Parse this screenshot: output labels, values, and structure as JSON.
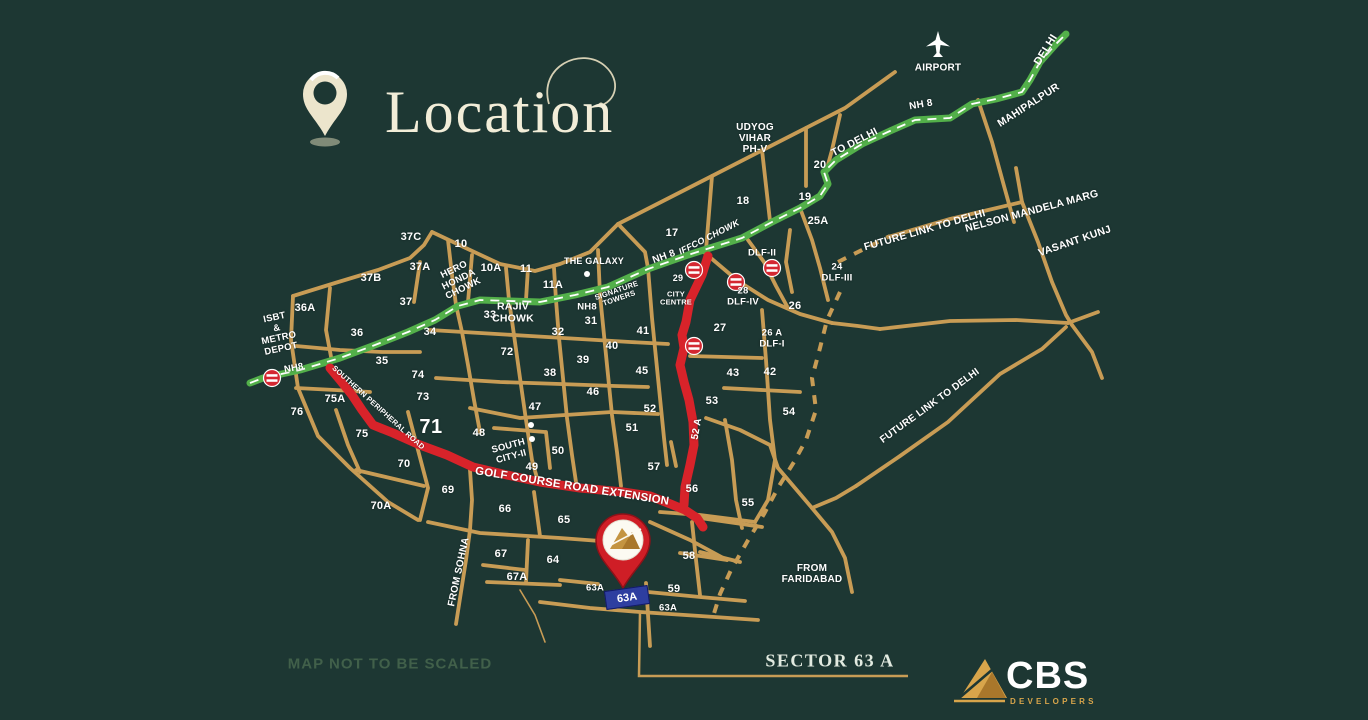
{
  "header": {
    "title": "Location"
  },
  "footer": {
    "disclaimer": "MAP NOT TO BE SCALED",
    "sector_label": "SECTOR 63 A",
    "logo_name": "CBS",
    "logo_sub": "DEVELOPERS"
  },
  "colors": {
    "background": "#1d3733",
    "road": "#c89c55",
    "highway_green": "#53b04a",
    "route_red": "#d8232a",
    "title_cream": "#f2edd8",
    "highlight_blue": "#2e3ea0",
    "logo_gold": "#d8a54b"
  },
  "icons": [
    "location-pin-icon",
    "airplane-icon",
    "metro-station-icon",
    "site-pin-icon",
    "cbs-mountain-icon"
  ],
  "map": {
    "highlight": "63A",
    "labels": [
      {
        "t": "AIRPORT",
        "x": 938,
        "y": 68,
        "s": 10,
        "cls": "wb"
      },
      {
        "t": "DELHI",
        "x": 1046,
        "y": 50,
        "r": -58,
        "s": 11,
        "cls": "wb"
      },
      {
        "t": "NH 8",
        "x": 921,
        "y": 105,
        "r": -10,
        "s": 10,
        "cls": "wb"
      },
      {
        "t": "MAHIPALPUR",
        "x": 1029,
        "y": 106,
        "r": -33,
        "s": 10.5,
        "cls": "wb"
      },
      {
        "t": "TO DELHI",
        "x": 855,
        "y": 143,
        "r": -27,
        "s": 10.5,
        "cls": "wb"
      },
      {
        "t": "UDYOG\nVIHAR\nPH-V",
        "x": 755,
        "y": 139,
        "s": 10,
        "cls": "wb"
      },
      {
        "t": "20",
        "x": 820,
        "y": 165
      },
      {
        "t": "19",
        "x": 805,
        "y": 197
      },
      {
        "t": "18",
        "x": 743,
        "y": 201
      },
      {
        "t": "25A",
        "x": 818,
        "y": 221
      },
      {
        "t": "17",
        "x": 672,
        "y": 233
      },
      {
        "t": "FUTURE LINK TO DELHI",
        "x": 925,
        "y": 231,
        "r": -16,
        "s": 10.5,
        "cls": "wb"
      },
      {
        "t": "NELSON MANDELA MARG",
        "x": 1032,
        "y": 212,
        "r": -15,
        "s": 10.5,
        "cls": "wb"
      },
      {
        "t": "VASANT KUNJ",
        "x": 1075,
        "y": 242,
        "r": -19,
        "s": 10.5,
        "cls": "wb"
      },
      {
        "t": "IFFCO CHOWK",
        "x": 709,
        "y": 237,
        "r": -27,
        "s": 9,
        "cls": "wb it"
      },
      {
        "t": "NH 8",
        "x": 664,
        "y": 257,
        "r": -20,
        "s": 10,
        "cls": "wb"
      },
      {
        "t": "DLF-II",
        "x": 762,
        "y": 254,
        "s": 9.5,
        "cls": "wb"
      },
      {
        "t": "24\nDLF-III",
        "x": 837,
        "y": 273,
        "s": 9.5,
        "cls": "wb"
      },
      {
        "t": "26",
        "x": 795,
        "y": 306
      },
      {
        "t": "37C",
        "x": 411,
        "y": 237
      },
      {
        "t": "10",
        "x": 461,
        "y": 244
      },
      {
        "t": "37A",
        "x": 420,
        "y": 267
      },
      {
        "t": "10A",
        "x": 491,
        "y": 268
      },
      {
        "t": "11",
        "x": 526,
        "y": 269
      },
      {
        "t": "37B",
        "x": 371,
        "y": 278
      },
      {
        "t": "11A",
        "x": 553,
        "y": 285
      },
      {
        "t": "HERO\nHONDA\nCHOWK",
        "x": 459,
        "y": 280,
        "r": -26,
        "s": 9.5,
        "cls": "wb"
      },
      {
        "t": "THE GALAXY",
        "x": 594,
        "y": 261,
        "s": 9,
        "cls": "wb"
      },
      {
        "t": "SIGNATURE\nTOWERS",
        "x": 618,
        "y": 295,
        "r": -19,
        "s": 7.5,
        "cls": "wb"
      },
      {
        "t": "29",
        "x": 678,
        "y": 278,
        "s": 9
      },
      {
        "t": "CITY\nCENTRE",
        "x": 676,
        "y": 299,
        "s": 7.5,
        "cls": "wb"
      },
      {
        "t": "28\nDLF-IV",
        "x": 743,
        "y": 297,
        "s": 9.5,
        "cls": "wb"
      },
      {
        "t": "37",
        "x": 406,
        "y": 302
      },
      {
        "t": "36A",
        "x": 305,
        "y": 308
      },
      {
        "t": "33",
        "x": 490,
        "y": 315
      },
      {
        "t": "RAJIV\nCHOWK",
        "x": 513,
        "y": 313,
        "s": 10.5,
        "cls": "wb"
      },
      {
        "t": "NH8",
        "x": 587,
        "y": 308,
        "s": 9.5,
        "cls": "wb"
      },
      {
        "t": "31",
        "x": 591,
        "y": 321
      },
      {
        "t": "32",
        "x": 558,
        "y": 332
      },
      {
        "t": "34",
        "x": 430,
        "y": 332
      },
      {
        "t": "36",
        "x": 357,
        "y": 333
      },
      {
        "t": "41",
        "x": 643,
        "y": 331
      },
      {
        "t": "27",
        "x": 720,
        "y": 328
      },
      {
        "t": "26 A\nDLF-I",
        "x": 772,
        "y": 339,
        "s": 9.5,
        "cls": "wb"
      },
      {
        "t": "ISBT\n&\nMETRO\nDEPOT",
        "x": 278,
        "y": 334,
        "r": -12,
        "s": 9.5,
        "cls": "wb"
      },
      {
        "t": "40",
        "x": 612,
        "y": 346
      },
      {
        "t": "72",
        "x": 507,
        "y": 352
      },
      {
        "t": "35",
        "x": 382,
        "y": 361
      },
      {
        "t": "39",
        "x": 583,
        "y": 360
      },
      {
        "t": "NH8",
        "x": 294,
        "y": 369,
        "r": -10,
        "s": 9.5,
        "cls": "wb"
      },
      {
        "t": "38",
        "x": 550,
        "y": 373
      },
      {
        "t": "45",
        "x": 642,
        "y": 371
      },
      {
        "t": "43",
        "x": 733,
        "y": 373
      },
      {
        "t": "42",
        "x": 770,
        "y": 372
      },
      {
        "t": "74",
        "x": 418,
        "y": 375
      },
      {
        "t": "46",
        "x": 593,
        "y": 392
      },
      {
        "t": "73",
        "x": 423,
        "y": 397
      },
      {
        "t": "75A",
        "x": 335,
        "y": 399
      },
      {
        "t": "53",
        "x": 712,
        "y": 401
      },
      {
        "t": "SOUTHERN PERIPHERAL ROAD",
        "x": 378,
        "y": 408,
        "r": 42,
        "s": 7.5,
        "cls": "wb"
      },
      {
        "t": "FUTURE LINK TO DELHI",
        "x": 930,
        "y": 406,
        "r": -36,
        "s": 10,
        "cls": "wb"
      },
      {
        "t": "52",
        "x": 650,
        "y": 409
      },
      {
        "t": "76",
        "x": 297,
        "y": 412
      },
      {
        "t": "47",
        "x": 535,
        "y": 407
      },
      {
        "t": "54",
        "x": 789,
        "y": 412
      },
      {
        "t": "52 A",
        "x": 697,
        "y": 429,
        "r": -80,
        "s": 10,
        "cls": "wb"
      },
      {
        "t": "51",
        "x": 632,
        "y": 428
      },
      {
        "t": "71",
        "x": 431,
        "y": 427,
        "s": 20,
        "cls": "sec-lg"
      },
      {
        "t": "75",
        "x": 362,
        "y": 434
      },
      {
        "t": "48",
        "x": 479,
        "y": 433
      },
      {
        "t": "SOUTH\nCITY-II",
        "x": 510,
        "y": 452,
        "r": -15,
        "s": 9.5,
        "cls": "wb"
      },
      {
        "t": "50",
        "x": 558,
        "y": 451
      },
      {
        "t": "70",
        "x": 404,
        "y": 464
      },
      {
        "t": "49",
        "x": 532,
        "y": 467
      },
      {
        "t": "57",
        "x": 654,
        "y": 467
      },
      {
        "t": "GOLF COURSE ROAD EXTENSION",
        "x": 572,
        "y": 487,
        "r": 9,
        "s": 11.5,
        "cls": "wb"
      },
      {
        "t": "69",
        "x": 448,
        "y": 490
      },
      {
        "t": "56",
        "x": 692,
        "y": 489
      },
      {
        "t": "55",
        "x": 748,
        "y": 503
      },
      {
        "t": "70A",
        "x": 381,
        "y": 506
      },
      {
        "t": "66",
        "x": 505,
        "y": 509
      },
      {
        "t": "65",
        "x": 564,
        "y": 520
      },
      {
        "t": "64",
        "x": 553,
        "y": 560
      },
      {
        "t": "67",
        "x": 501,
        "y": 554
      },
      {
        "t": "FROM SOHNA",
        "x": 459,
        "y": 572,
        "r": -78,
        "s": 10,
        "cls": "wb"
      },
      {
        "t": "67A",
        "x": 517,
        "y": 577
      },
      {
        "t": "FROM\nFARIDABAD",
        "x": 812,
        "y": 574,
        "s": 10,
        "cls": "wb"
      },
      {
        "t": "58",
        "x": 689,
        "y": 556
      },
      {
        "t": "59",
        "x": 674,
        "y": 589
      },
      {
        "t": "63A",
        "x": 595,
        "y": 589,
        "s": 9.5
      },
      {
        "t": "63A",
        "x": 668,
        "y": 609,
        "s": 9.5
      }
    ]
  }
}
